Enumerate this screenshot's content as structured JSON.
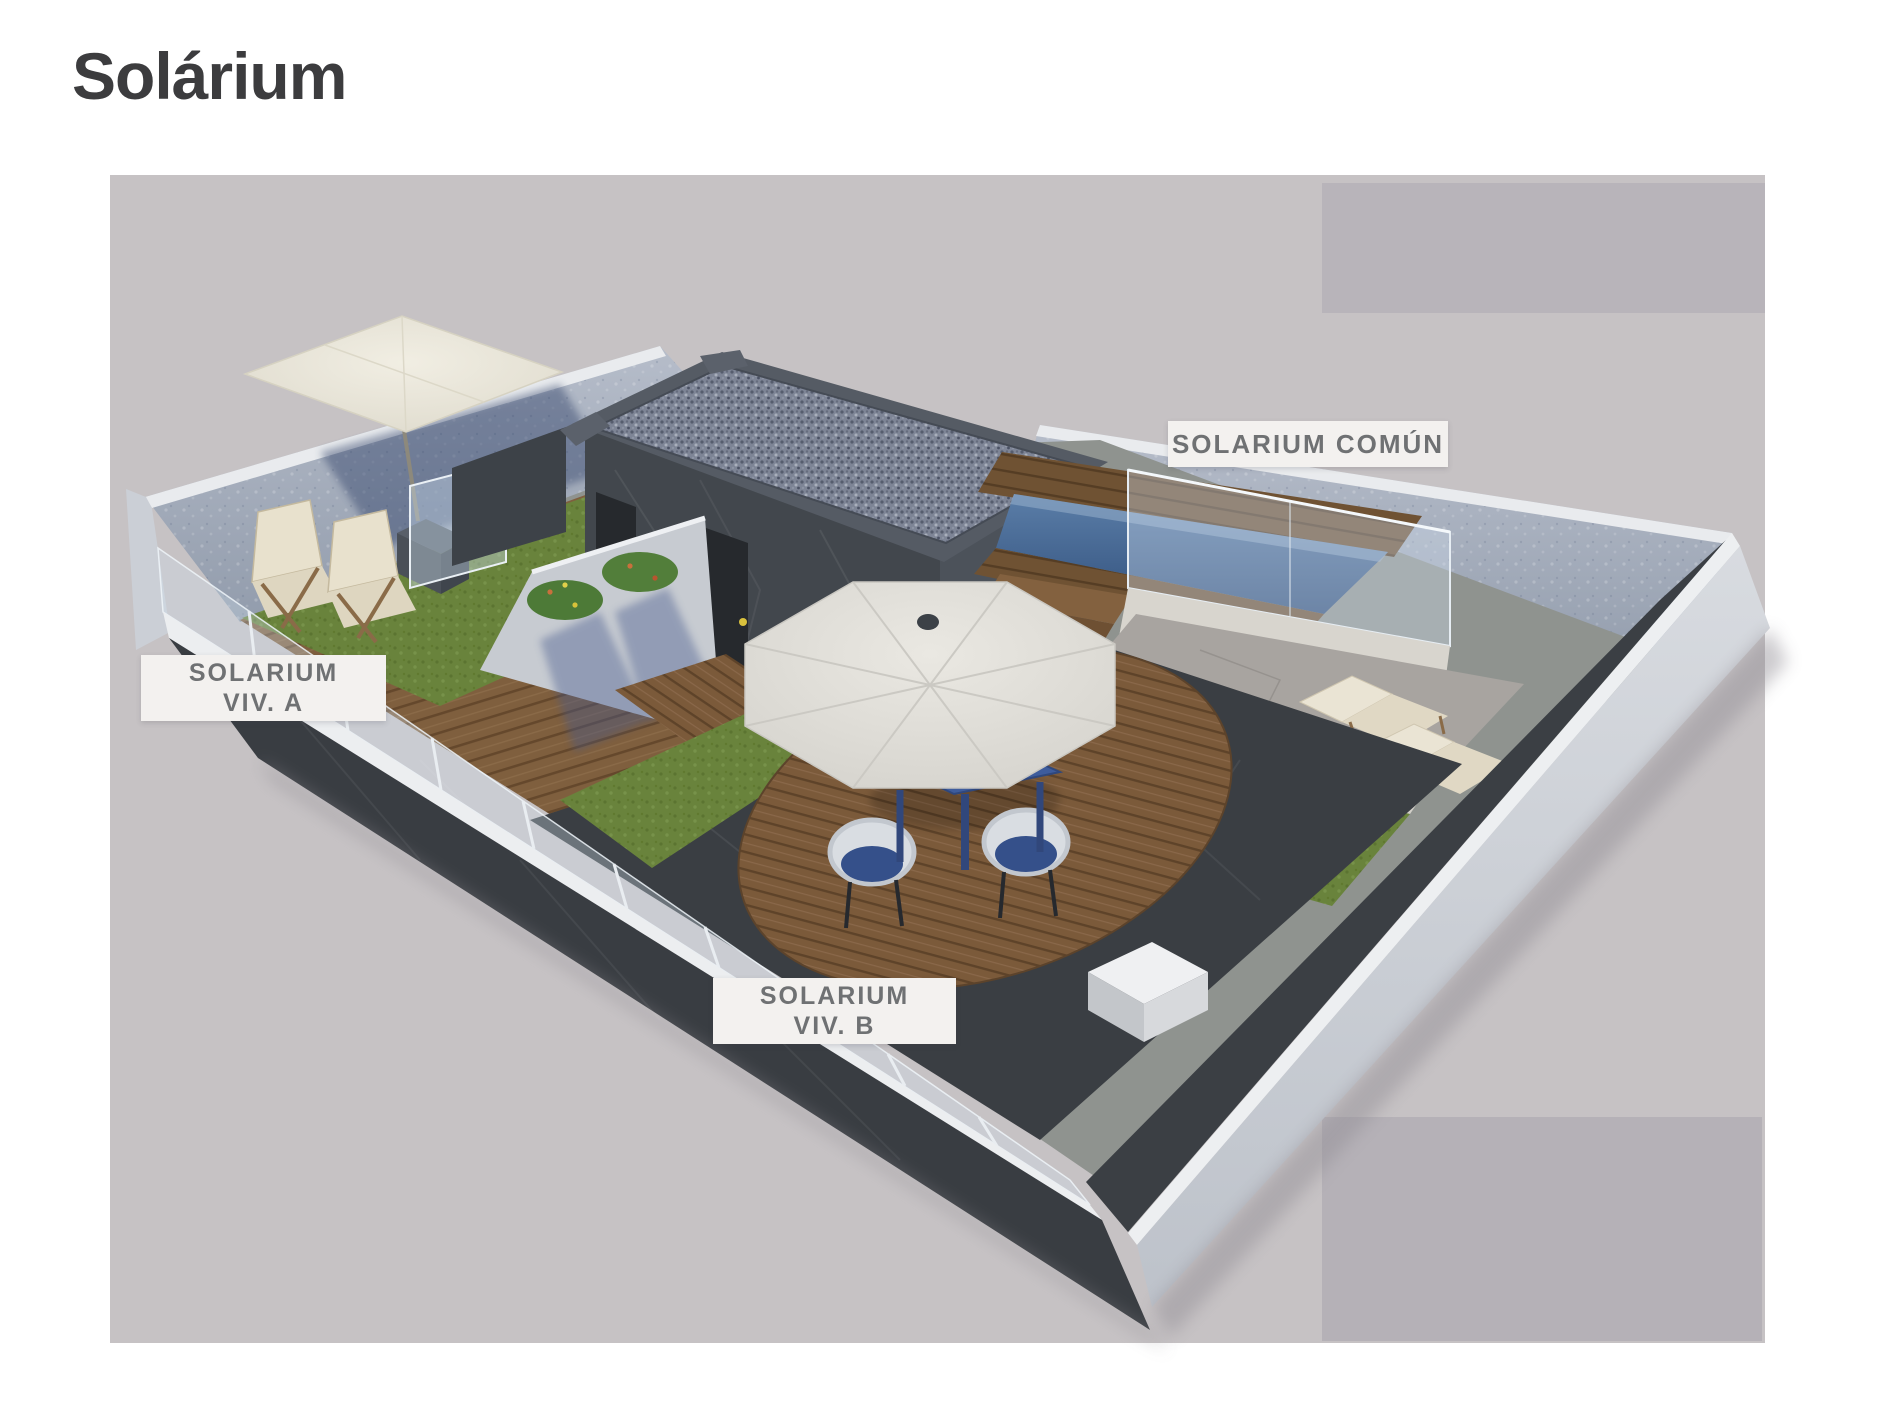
{
  "header": {
    "title": "Solárium"
  },
  "scene": {
    "labels": [
      {
        "id": "solarium-comun",
        "lines": [
          "SOLARIUM COMÚN"
        ]
      },
      {
        "id": "solarium-viv-a",
        "lines": [
          "SOLARIUM",
          "VIV. A"
        ]
      },
      {
        "id": "solarium-viv-b",
        "lines": [
          "SOLARIUM",
          "VIV. B"
        ]
      }
    ]
  },
  "colors": {
    "page_bg": "#ffffff",
    "title_text": "#3c3c3e",
    "canvas_bg": "#c6c2c4",
    "canvas_panel_top": "#b8b4ba",
    "canvas_panel_bottom": "#b5b1b7",
    "label_bg": "#f3f1ef",
    "label_text": "#6f7173",
    "grass_green": "#69833c",
    "wood_deck": "#7d5c3c",
    "pool_water": "#3f6190",
    "building_dark": "#42474d",
    "outer_wall_light": "#ced2d8",
    "rear_wall_blue_gray": "#a3adbc",
    "umbrella_cream": "#e7e4da",
    "furniture_blue": "#3e5c9a"
  }
}
